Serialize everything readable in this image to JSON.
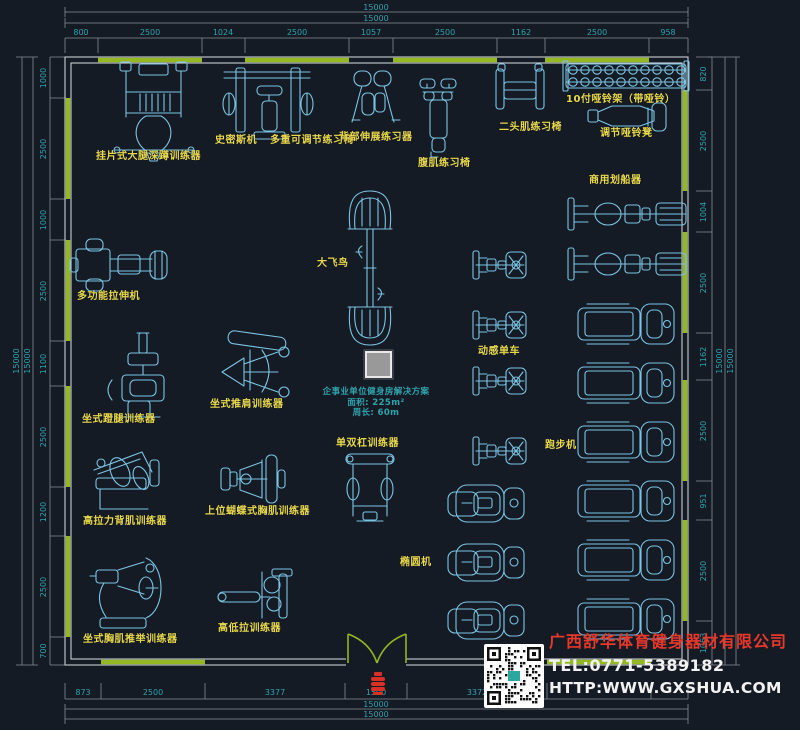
{
  "colors": {
    "background": "#151b24",
    "equipment_line_art": "#7cc4e4",
    "equipment_labels": "#e9d94e",
    "dimension_text": "#2fa3ad",
    "wall_window_green": "#93b821",
    "wall_frame_gray": "#c9ced3",
    "company_name_red": "#e8372b",
    "contact_text_white": "#f2f2f2",
    "door_marker_red": "#d93025",
    "column_gray": "#999999"
  },
  "plan": {
    "solution": {
      "title": "企事业单位健身房解决方案",
      "area": "面积: 225m²",
      "perimeter": "周长: 60m"
    },
    "equipment_labels": [
      {
        "id": "squat-trainer",
        "text": "挂片式大腿深蹲训练器",
        "x": 96,
        "y": 147
      },
      {
        "id": "smith-machine",
        "text": "史密斯机",
        "x": 215,
        "y": 131
      },
      {
        "id": "adjustable-bench",
        "text": "多重可调节练习椅",
        "x": 270,
        "y": 131
      },
      {
        "id": "back-extension",
        "text": "背部伸展练习器",
        "x": 339,
        "y": 128
      },
      {
        "id": "ab-bench",
        "text": "腹肌练习椅",
        "x": 418,
        "y": 154
      },
      {
        "id": "biceps-bench",
        "text": "二头肌练习椅",
        "x": 499,
        "y": 118
      },
      {
        "id": "dumbbell-rack",
        "text": "10付哑铃架（带哑铃）",
        "x": 566,
        "y": 90
      },
      {
        "id": "dumbbell-bench",
        "text": "调节哑铃凳",
        "x": 600,
        "y": 124
      },
      {
        "id": "rowing-machine",
        "text": "商用划船器",
        "x": 589,
        "y": 171
      },
      {
        "id": "stretch-machine",
        "text": "多功能拉伸机",
        "x": 77,
        "y": 287
      },
      {
        "id": "cable-crossover",
        "text": "大飞鸟",
        "x": 317,
        "y": 254
      },
      {
        "id": "spin-bike",
        "text": "动感单车",
        "x": 478,
        "y": 342
      },
      {
        "id": "leg-press",
        "text": "坐式蹬腿训练器",
        "x": 82,
        "y": 410
      },
      {
        "id": "shoulder-press",
        "text": "坐式推肩训练器",
        "x": 210,
        "y": 395
      },
      {
        "id": "dip-station",
        "text": "单双杠训练器",
        "x": 336,
        "y": 434
      },
      {
        "id": "treadmill",
        "text": "跑步机",
        "x": 545,
        "y": 436
      },
      {
        "id": "lat-pulldown",
        "text": "高拉力背肌训练器",
        "x": 83,
        "y": 512
      },
      {
        "id": "pec-fly",
        "text": "上位蝴蝶式胸肌训练器",
        "x": 205,
        "y": 502
      },
      {
        "id": "elliptical",
        "text": "椭圆机",
        "x": 400,
        "y": 553
      },
      {
        "id": "chest-press",
        "text": "坐式胸肌推举训练器",
        "x": 83,
        "y": 630
      },
      {
        "id": "high-low-pulley",
        "text": "高低拉训练器",
        "x": 218,
        "y": 619
      }
    ]
  },
  "dimensions": {
    "top": {
      "totals": [
        {
          "t": "15000",
          "x": 376,
          "y": 10
        },
        {
          "t": "15000",
          "x": 376,
          "y": 21
        }
      ],
      "segments": [
        {
          "t": "800",
          "x": 81,
          "y": 35
        },
        {
          "t": "2500",
          "x": 150,
          "y": 35
        },
        {
          "t": "1024",
          "x": 223,
          "y": 35
        },
        {
          "t": "2500",
          "x": 297,
          "y": 35
        },
        {
          "t": "1057",
          "x": 371,
          "y": 35
        },
        {
          "t": "2500",
          "x": 445,
          "y": 35
        },
        {
          "t": "1162",
          "x": 521,
          "y": 35
        },
        {
          "t": "2500",
          "x": 597,
          "y": 35
        },
        {
          "t": "958",
          "x": 668,
          "y": 35
        }
      ]
    },
    "bottom": {
      "totals": [
        {
          "t": "15000",
          "x": 376,
          "y": 707
        },
        {
          "t": "15000",
          "x": 376,
          "y": 717
        }
      ],
      "segments": [
        {
          "t": "873",
          "x": 83,
          "y": 695
        },
        {
          "t": "2500",
          "x": 153,
          "y": 695
        },
        {
          "t": "3377",
          "x": 275,
          "y": 695
        },
        {
          "t": "1500",
          "x": 376,
          "y": 695
        },
        {
          "t": "3372",
          "x": 477,
          "y": 695
        }
      ]
    },
    "left": {
      "totals": [
        {
          "t": "15000",
          "x": 19,
          "y": 361,
          "rot": true
        },
        {
          "t": "15000",
          "x": 30,
          "y": 361,
          "rot": true
        }
      ],
      "segments": [
        {
          "t": "1000",
          "x": 46,
          "y": 78,
          "rot": true
        },
        {
          "t": "2500",
          "x": 46,
          "y": 149,
          "rot": true
        },
        {
          "t": "1000",
          "x": 46,
          "y": 220,
          "rot": true
        },
        {
          "t": "2500",
          "x": 46,
          "y": 291,
          "rot": true
        },
        {
          "t": "1100",
          "x": 46,
          "y": 364,
          "rot": true
        },
        {
          "t": "2500",
          "x": 46,
          "y": 437,
          "rot": true
        },
        {
          "t": "1200",
          "x": 46,
          "y": 512,
          "rot": true
        },
        {
          "t": "2500",
          "x": 46,
          "y": 587,
          "rot": true
        },
        {
          "t": "700",
          "x": 46,
          "y": 651,
          "rot": true
        }
      ]
    },
    "right": {
      "totals": [
        {
          "t": "15000",
          "x": 722,
          "y": 361,
          "rot": true
        },
        {
          "t": "15000",
          "x": 733,
          "y": 361,
          "rot": true
        }
      ],
      "segments": [
        {
          "t": "820",
          "x": 706,
          "y": 74,
          "rot": true
        },
        {
          "t": "2500",
          "x": 706,
          "y": 141,
          "rot": true
        },
        {
          "t": "1004",
          "x": 706,
          "y": 212,
          "rot": true
        },
        {
          "t": "2500",
          "x": 706,
          "y": 283,
          "rot": true
        },
        {
          "t": "1162",
          "x": 706,
          "y": 357,
          "rot": true
        },
        {
          "t": "2500",
          "x": 706,
          "y": 431,
          "rot": true
        },
        {
          "t": "951",
          "x": 706,
          "y": 501,
          "rot": true
        },
        {
          "t": "2500",
          "x": 706,
          "y": 571,
          "rot": true
        },
        {
          "t": "1063",
          "x": 706,
          "y": 643,
          "rot": true
        }
      ]
    }
  },
  "company": {
    "name": "广西舒华体育健身器材有限公司",
    "tel": "TEL:0771-5389182",
    "website": "HTTP:WWW.GXSHUA.COM"
  }
}
